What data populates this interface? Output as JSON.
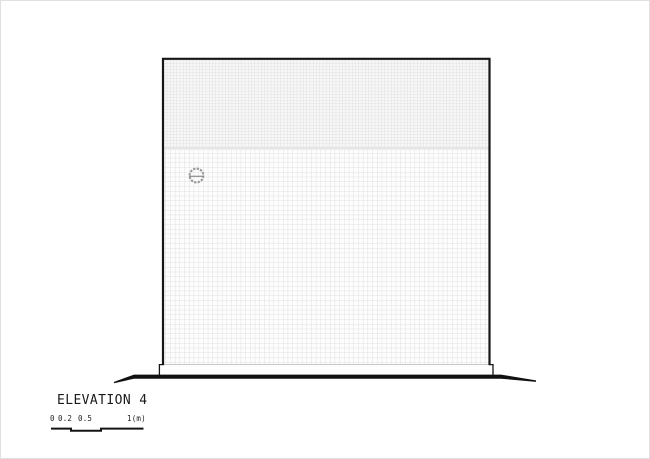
{
  "drawing": {
    "title": "ELEVATION 4",
    "type": "architectural elevation",
    "elements": {
      "wall_face": "square facade clad in small square tiles",
      "upper_band": "denser fine tile grid band across the top of the facade",
      "lower_band": "coarser tile grid on the main facade area",
      "vent": "small dashed circular wall vent with horizontal slat, upper-left of facade",
      "plinth": "slightly projecting foundation step at the wall base",
      "ground": "thick tapered ground line extending beyond both sides of the building"
    },
    "colors": {
      "outline": "#161616",
      "tile_line": "#d9d9d9",
      "upper_band_bg": "#f7f7f7",
      "lower_band_bg": "#fdfdfd",
      "band_divider": "#e6e6e6",
      "tile_bottom_edge": "#c8c8c8",
      "vent_ring": "#9a9a9a",
      "vent_slat": "#8c8c8c",
      "ground_line": "#111111",
      "canvas_border": "#e0e0e0",
      "background": "#ffffff",
      "text": "#1b1b1b"
    }
  },
  "scalebar": {
    "labels": [
      "0",
      "0.2",
      "0.5",
      "1(m)"
    ],
    "unit": "m"
  }
}
